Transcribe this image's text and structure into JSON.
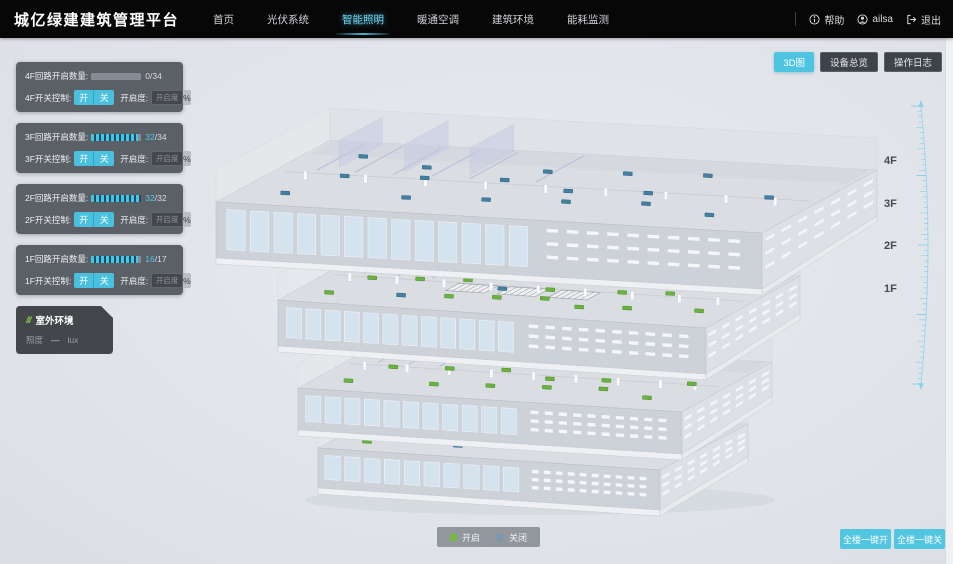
{
  "header": {
    "title": "城亿绿建建筑管理平台",
    "nav": [
      {
        "label": "首页"
      },
      {
        "label": "光伏系统"
      },
      {
        "label": "智能照明"
      },
      {
        "label": "暖通空调"
      },
      {
        "label": "建筑环境"
      },
      {
        "label": "能耗监测"
      }
    ],
    "active_nav_index": 2,
    "help": "帮助",
    "username": "ailsa",
    "logout": "退出"
  },
  "toolbar": {
    "view_3d": "3D图",
    "device_overview": "设备总览",
    "operation_log": "操作日志"
  },
  "floor_panels": [
    {
      "floor": "4F",
      "circuit_label": "4F回路开启数量:",
      "on": 0,
      "total": 34,
      "switch_label": "4F开关控制:",
      "btn_on": "开",
      "btn_off": "关",
      "dim_label": "开启度:",
      "dim_placeholder": "开启度",
      "unit": "%"
    },
    {
      "floor": "3F",
      "circuit_label": "3F回路开启数量:",
      "on": 32,
      "total": 34,
      "switch_label": "3F开关控制:",
      "btn_on": "开",
      "btn_off": "关",
      "dim_label": "开启度:",
      "dim_placeholder": "开启度",
      "unit": "%"
    },
    {
      "floor": "2F",
      "circuit_label": "2F回路开启数量:",
      "on": 32,
      "total": 32,
      "switch_label": "2F开关控制:",
      "btn_on": "开",
      "btn_off": "关",
      "dim_label": "开启度:",
      "dim_placeholder": "开启度",
      "unit": "%"
    },
    {
      "floor": "1F",
      "circuit_label": "1F回路开启数量:",
      "on": 16,
      "total": 17,
      "switch_label": "1F开关控制:",
      "btn_on": "开",
      "btn_off": "关",
      "dim_label": "开启度:",
      "dim_placeholder": "开启度",
      "unit": "%"
    }
  ],
  "env_panel": {
    "title": "室外环境",
    "metric": "照度",
    "value": "—",
    "unit": "lux"
  },
  "legend": {
    "on_label": "开启",
    "on_color": "#74b843",
    "off_label": "关闭",
    "off_color": "#7b96ae"
  },
  "bulk": {
    "all_on": "全楼一键开",
    "all_off": "全楼一键关"
  },
  "floor_labels": [
    "4F",
    "3F",
    "2F",
    "1F"
  ],
  "building": {
    "floors": [
      {
        "name": "4F",
        "lights_on": 0,
        "lights_off": 17
      },
      {
        "name": "3F",
        "lights_on": 20,
        "lights_off": 2
      },
      {
        "name": "2F",
        "lights_on": 18,
        "lights_off": 0
      },
      {
        "name": "1F",
        "lights_on": 12,
        "lights_off": 1
      }
    ],
    "light_on_color": "#6ab33e",
    "light_off_color": "#44809f"
  }
}
